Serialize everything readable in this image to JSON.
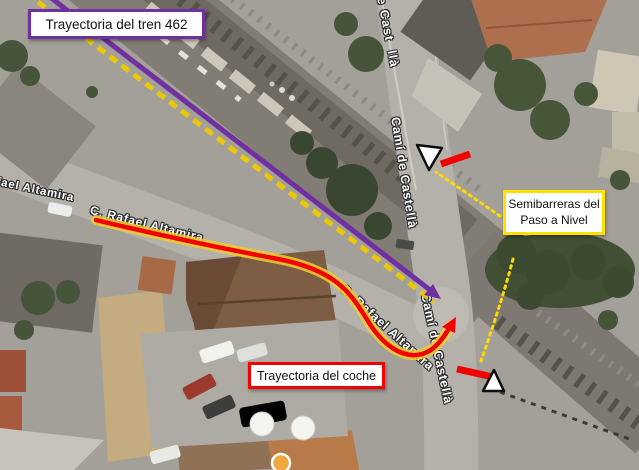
{
  "callouts": {
    "train": {
      "label": "Trayectoria del tren 462"
    },
    "barriers": {
      "line1": "Semibarreras del",
      "line2": "Paso a Nivel"
    },
    "car": {
      "label": "Trayectoria del coche"
    }
  },
  "street_labels": {
    "rafael_altamira_partial": "fael Altamira",
    "c_rafael_altamira_west": "C. Rafael Altamira",
    "c_rafael_altamira_south": "C. Rafael Altamira",
    "cami_castella_top": "e Cast  llà",
    "cami_castella_mid": "Camí de Castellà",
    "cami_castella_south": "Camí de Castellà"
  },
  "colors": {
    "train_line": "#7030A0",
    "railway_dashed": "#EEC900",
    "car_line": "#F40000",
    "car_glow": "#F2CC2E",
    "barrier_bar": "#F40000",
    "connector_dotted": "#FFD900",
    "train_box_border": "#7030A0",
    "barrier_box_border": "#FFE000",
    "car_box_border": "#F40000"
  }
}
